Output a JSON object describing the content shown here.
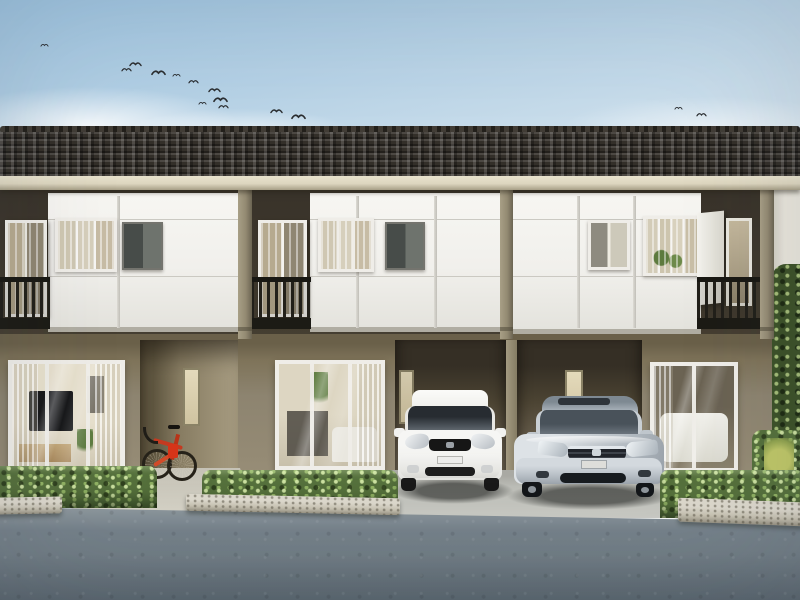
{
  "meta": {
    "domain": "natural-image",
    "description": "Photorealistic 3D render of a modern two-storey townhouse row with three visible units: dark tiled roof, white upper panels with balconies and dark metal railings, olive-taupe ground floor with large living-room windows, two carports holding a white hatchback and a silver sedan, a red road bicycle at the entry porch, trimmed box hedges with granite curbs, a concrete walkway and an asphalt forecourt under a clear blue sky with a flock of birds."
  },
  "colors": {
    "skyTop": "#9cc2de",
    "skyMid": "#c9ddeb",
    "skyLow": "#e9f0f3",
    "roofDark": "#332f29",
    "fascia": "#ddd6bf",
    "upperWall": "#453e31",
    "panel": "#f1f0ec",
    "pillar": "#938a72",
    "railing": "#22201a",
    "frameWhite": "#efede8",
    "groundWall": "#8d8470",
    "recess": "#352f25",
    "slotGlow": "#e4dabb",
    "endWall": "#e9e6dc",
    "hedge": "#55703c",
    "plantYellow": "#bfc768",
    "curb": "#c6c1b1",
    "walk": "#cfccc0",
    "apron": "#bcbdb7",
    "asphalt": "#717d85",
    "asphaltLight": "#8b959b",
    "carWhite": "#f6f6f4",
    "carSilver": "#c6ccd1",
    "bikeRed": "#c43a20"
  },
  "scene": {
    "sky": {
      "birds": [
        [
          38,
          34
        ],
        [
          120,
          58
        ],
        [
          129,
          52
        ],
        [
          152,
          60
        ],
        [
          170,
          64
        ],
        [
          187,
          70
        ],
        [
          208,
          78
        ],
        [
          214,
          87
        ],
        [
          196,
          92
        ],
        [
          217,
          95
        ],
        [
          270,
          99
        ],
        [
          292,
          104
        ],
        [
          672,
          97
        ],
        [
          695,
          103
        ]
      ],
      "clouds": 3
    },
    "building": {
      "storeys": 2,
      "visible_units": 3,
      "roof": "dark concrete tile hip roof",
      "upper_facade": "white panels, curtained windows, balconies with dark vertical-bar railings",
      "lower_facade": "olive-taupe walls with large white-framed living-room windows",
      "units": [
        {
          "id": 1,
          "upper": [
            "balcony-left",
            "curtained-window",
            "dark-framed-window"
          ],
          "lower": [
            "living-room-window",
            "entry-porch-with-bicycle",
            "slot-window"
          ]
        },
        {
          "id": 2,
          "upper": [
            "balcony-left",
            "curtained-window",
            "dark-framed-window"
          ],
          "lower": [
            "living-room-window",
            "carport-with-white-hatchback",
            "slot-window"
          ]
        },
        {
          "id": 3,
          "upper": [
            "two-pane-window",
            "curtained-window-with-plants",
            "balcony-right-open-door"
          ],
          "lower": [
            "carport-with-silver-sedan",
            "living-room-window",
            "slot-window"
          ]
        }
      ]
    },
    "vehicles": [
      {
        "name": "white-hatchback",
        "color": "white",
        "position": "carport of unit 2"
      },
      {
        "name": "silver-sedan",
        "color": "silver",
        "position": "carport of unit 3"
      }
    ],
    "objects": [
      "red-road-bicycle",
      "boxwood-hedges",
      "granite-curbs",
      "concrete-walkway",
      "asphalt-forecourt",
      "shrubs-right-edge",
      "yellow-green-plant"
    ]
  }
}
